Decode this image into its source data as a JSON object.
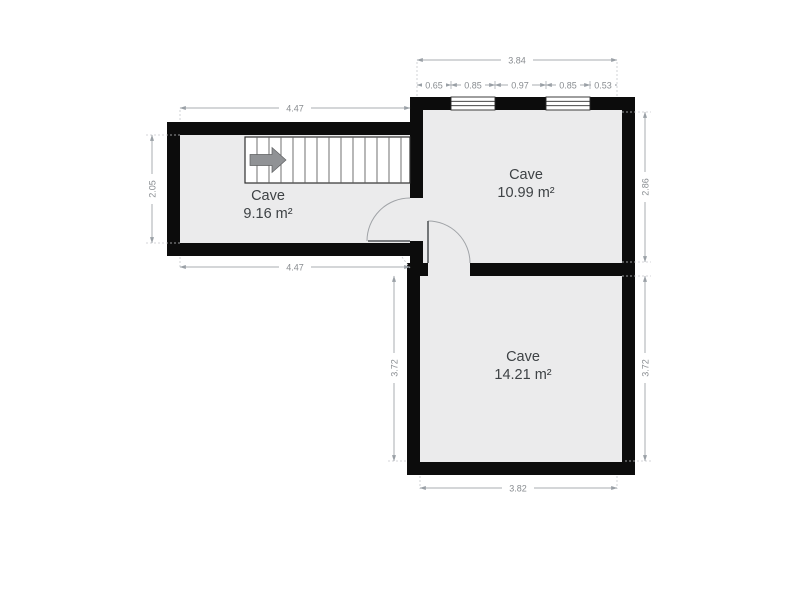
{
  "plan": {
    "type": "floor-plan",
    "rooms": [
      {
        "name": "Cave",
        "area": "9.16 m²"
      },
      {
        "name": "Cave",
        "area": "10.99 m²"
      },
      {
        "name": "Cave",
        "area": "14.21 m²"
      }
    ],
    "dimensions": {
      "top_total": "3.84",
      "top_segments": [
        "0.65",
        "0.85",
        "0.97",
        "0.85",
        "0.53"
      ],
      "left_room_width_top": "4.47",
      "left_room_width_bottom": "4.47",
      "left_room_height": "2.05",
      "right_room_height": "2.86",
      "bottom_room_height_right": "3.72",
      "bottom_room_height_left": "3.72",
      "bottom_room_width": "3.82"
    },
    "icons": {
      "stairs_arrow": "right-arrow"
    },
    "colors": {
      "wall": "#0c0c0c",
      "floor": "#ebebec",
      "dimension_line": "#a9acb1",
      "dimension_text": "#888c90",
      "room_text": "#3e4245",
      "stairs_arrow": "#909295",
      "background": "#ffffff"
    }
  }
}
